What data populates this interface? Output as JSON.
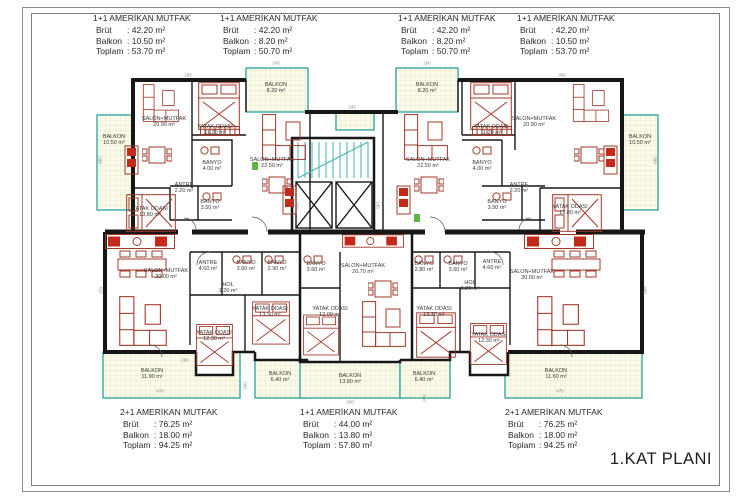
{
  "page": {
    "plan_title": "1.KAT PLANI"
  },
  "spec_labels": {
    "brut": "Brüt",
    "balkon": "Balkon",
    "toplam": "Toplam"
  },
  "units_top": [
    {
      "title": "1+1 AMERİKAN MUTFAK",
      "brut": ": 42.20 m²",
      "balkon": ": 10.50 m²",
      "toplam": ": 53.70 m²"
    },
    {
      "title": "1+1 AMERİKAN MUTFAK",
      "brut": ": 42.20 m²",
      "balkon": ": 8.20 m²",
      "toplam": ": 50.70 m²"
    },
    {
      "title": "1+1 AMERİKAN MUTFAK",
      "brut": ": 42.20 m²",
      "balkon": ": 8.20 m²",
      "toplam": ": 50.70 m²"
    },
    {
      "title": "1+1 AMERİKAN MUTFAK",
      "brut": ": 42.20 m²",
      "balkon": ": 10.50 m²",
      "toplam": ": 53.70 m²"
    }
  ],
  "units_bottom": [
    {
      "title": "2+1 AMERİKAN MUTFAK",
      "brut": ": 76.25 m²",
      "balkon": ": 18.00 m²",
      "toplam": ": 94.25 m²"
    },
    {
      "title": "1+1 AMERİKAN MUTFAK",
      "brut": ": 44.00 m²",
      "balkon": ": 13.80 m²",
      "toplam": ": 57.80 m²"
    },
    {
      "title": "2+1 AMERİKAN MUTFAK",
      "brut": ": 76.25 m²",
      "balkon": ": 18.00 m²",
      "toplam": ": 94.25 m²"
    }
  ],
  "colors": {
    "wall": "#171717",
    "furniture": "#a2382a",
    "furniture_fill": "#c32a1a",
    "balcony_border": "#35a8a5",
    "balcony_fill": "#fcfaea",
    "balcony_grid": "#dde4b8",
    "accent_green": "#5fb544",
    "text": "#2a2a2a"
  },
  "plan": {
    "room_labels": [
      {
        "n": "BALKON",
        "a": "10.50 m²",
        "x": 114,
        "y": 140
      },
      {
        "n": "SALON+MUTFAK",
        "a": "20.90 m²",
        "x": 164,
        "y": 122
      },
      {
        "n": "YATAK ODASI",
        "a": "11.20 m²",
        "x": 215,
        "y": 130
      },
      {
        "n": "BANYO",
        "a": "4.00 m²",
        "x": 212,
        "y": 166
      },
      {
        "n": "ANTRE",
        "a": "2.20 m²",
        "x": 184,
        "y": 188
      },
      {
        "n": "BANYO",
        "a": "3.50 m²",
        "x": 210,
        "y": 205
      },
      {
        "n": "YATAK ODASI",
        "a": "13.80 m²",
        "x": 150,
        "y": 212
      },
      {
        "n": "BALKON",
        "a": "8.20 m²",
        "x": 276,
        "y": 88
      },
      {
        "n": "SALON+MUTFAK",
        "a": "22.50 m²",
        "x": 272,
        "y": 163
      },
      {
        "n": "BALKON",
        "a": "8.20 m²",
        "x": 427,
        "y": 88
      },
      {
        "n": "SALON+MUTFAK",
        "a": "22.50 m²",
        "x": 428,
        "y": 163
      },
      {
        "n": "YATAK ODASI",
        "a": "11.20 m²",
        "x": 491,
        "y": 130
      },
      {
        "n": "BANYO",
        "a": "4.00 m²",
        "x": 482,
        "y": 166
      },
      {
        "n": "ANTRE",
        "a": "2.20 m²",
        "x": 519,
        "y": 188
      },
      {
        "n": "BANYO",
        "a": "3.50 m²",
        "x": 497,
        "y": 205
      },
      {
        "n": "SALON+MUTFAK",
        "a": "20.90 m²",
        "x": 534,
        "y": 122
      },
      {
        "n": "YATAK ODASI",
        "a": "13.80 m²",
        "x": 570,
        "y": 210
      },
      {
        "n": "BALKON",
        "a": "10.50 m²",
        "x": 640,
        "y": 140
      },
      {
        "n": "SALON+MUTFAK",
        "a": "30.00 m²",
        "x": 166,
        "y": 274
      },
      {
        "n": "ANTRE",
        "a": "4.60 m²",
        "x": 208,
        "y": 266
      },
      {
        "n": "BANYO",
        "a": "3.60 m²",
        "x": 246,
        "y": 266
      },
      {
        "n": "BANYO",
        "a": "2.90 m²",
        "x": 277,
        "y": 266
      },
      {
        "n": "HOL",
        "a": "1.20 m²",
        "x": 228,
        "y": 288
      },
      {
        "n": "YATAK ODASI",
        "a": "12.30 m²",
        "x": 214,
        "y": 336
      },
      {
        "n": "YATAK ODASI",
        "a": "13.30 m²",
        "x": 270,
        "y": 312
      },
      {
        "n": "BALKON",
        "a": "11.90 m²",
        "x": 152,
        "y": 374
      },
      {
        "n": "BALKON",
        "a": "6.40 m²",
        "x": 280,
        "y": 377
      },
      {
        "n": "BANYO",
        "a": "3.60 m²",
        "x": 316,
        "y": 267
      },
      {
        "n": "SALON+MUTFAK",
        "a": "20.70 m²",
        "x": 363,
        "y": 269
      },
      {
        "n": "YATAK ODASI",
        "a": "12.00 m²",
        "x": 330,
        "y": 312
      },
      {
        "n": "BALKON",
        "a": "13.80 m²",
        "x": 350,
        "y": 379
      },
      {
        "n": "BANYO",
        "a": "2.80 m²",
        "x": 424,
        "y": 267
      },
      {
        "n": "BANYO",
        "a": "3.60 m²",
        "x": 458,
        "y": 267
      },
      {
        "n": "YATAK ODASI",
        "a": "13.30 m²",
        "x": 434,
        "y": 312
      },
      {
        "n": "BALKON",
        "a": "6.40 m²",
        "x": 424,
        "y": 377
      },
      {
        "n": "ANTRE",
        "a": "4.60 m²",
        "x": 492,
        "y": 265
      },
      {
        "n": "HOL",
        "a": "1.20 m²",
        "x": 470,
        "y": 286
      },
      {
        "n": "SALON+MUTFAK",
        "a": "30.00 m²",
        "x": 532,
        "y": 275
      },
      {
        "n": "YATAK ODASI",
        "a": "12.30 m²",
        "x": 489,
        "y": 338
      },
      {
        "n": "BALKON",
        "a": "11.60 m²",
        "x": 556,
        "y": 374
      }
    ],
    "dimensions": [
      {
        "t": "290",
        "x": 188,
        "y": 75,
        "r": 0
      },
      {
        "t": "260",
        "x": 276,
        "y": 63,
        "r": 0
      },
      {
        "t": "260",
        "x": 427,
        "y": 63,
        "r": 0
      },
      {
        "t": "300",
        "x": 562,
        "y": 75,
        "r": 0
      },
      {
        "t": "200",
        "x": 100,
        "y": 160,
        "r": 90
      },
      {
        "t": "200",
        "x": 655,
        "y": 160,
        "r": 90
      },
      {
        "t": "180",
        "x": 352,
        "y": 107,
        "r": 0
      },
      {
        "t": "240",
        "x": 297,
        "y": 205,
        "r": 90
      },
      {
        "t": "145",
        "x": 378,
        "y": 205,
        "r": 90
      },
      {
        "t": "410",
        "x": 101,
        "y": 290,
        "r": 90
      },
      {
        "t": "440",
        "x": 645,
        "y": 290,
        "r": 90
      },
      {
        "t": "470",
        "x": 160,
        "y": 391,
        "r": 0
      },
      {
        "t": "290",
        "x": 185,
        "y": 360,
        "r": 0
      },
      {
        "t": "290",
        "x": 245,
        "y": 385,
        "r": 90
      },
      {
        "t": "300",
        "x": 350,
        "y": 402,
        "r": 0
      },
      {
        "t": "360",
        "x": 424,
        "y": 398,
        "r": 90
      },
      {
        "t": "475",
        "x": 560,
        "y": 391,
        "r": 0
      }
    ]
  }
}
